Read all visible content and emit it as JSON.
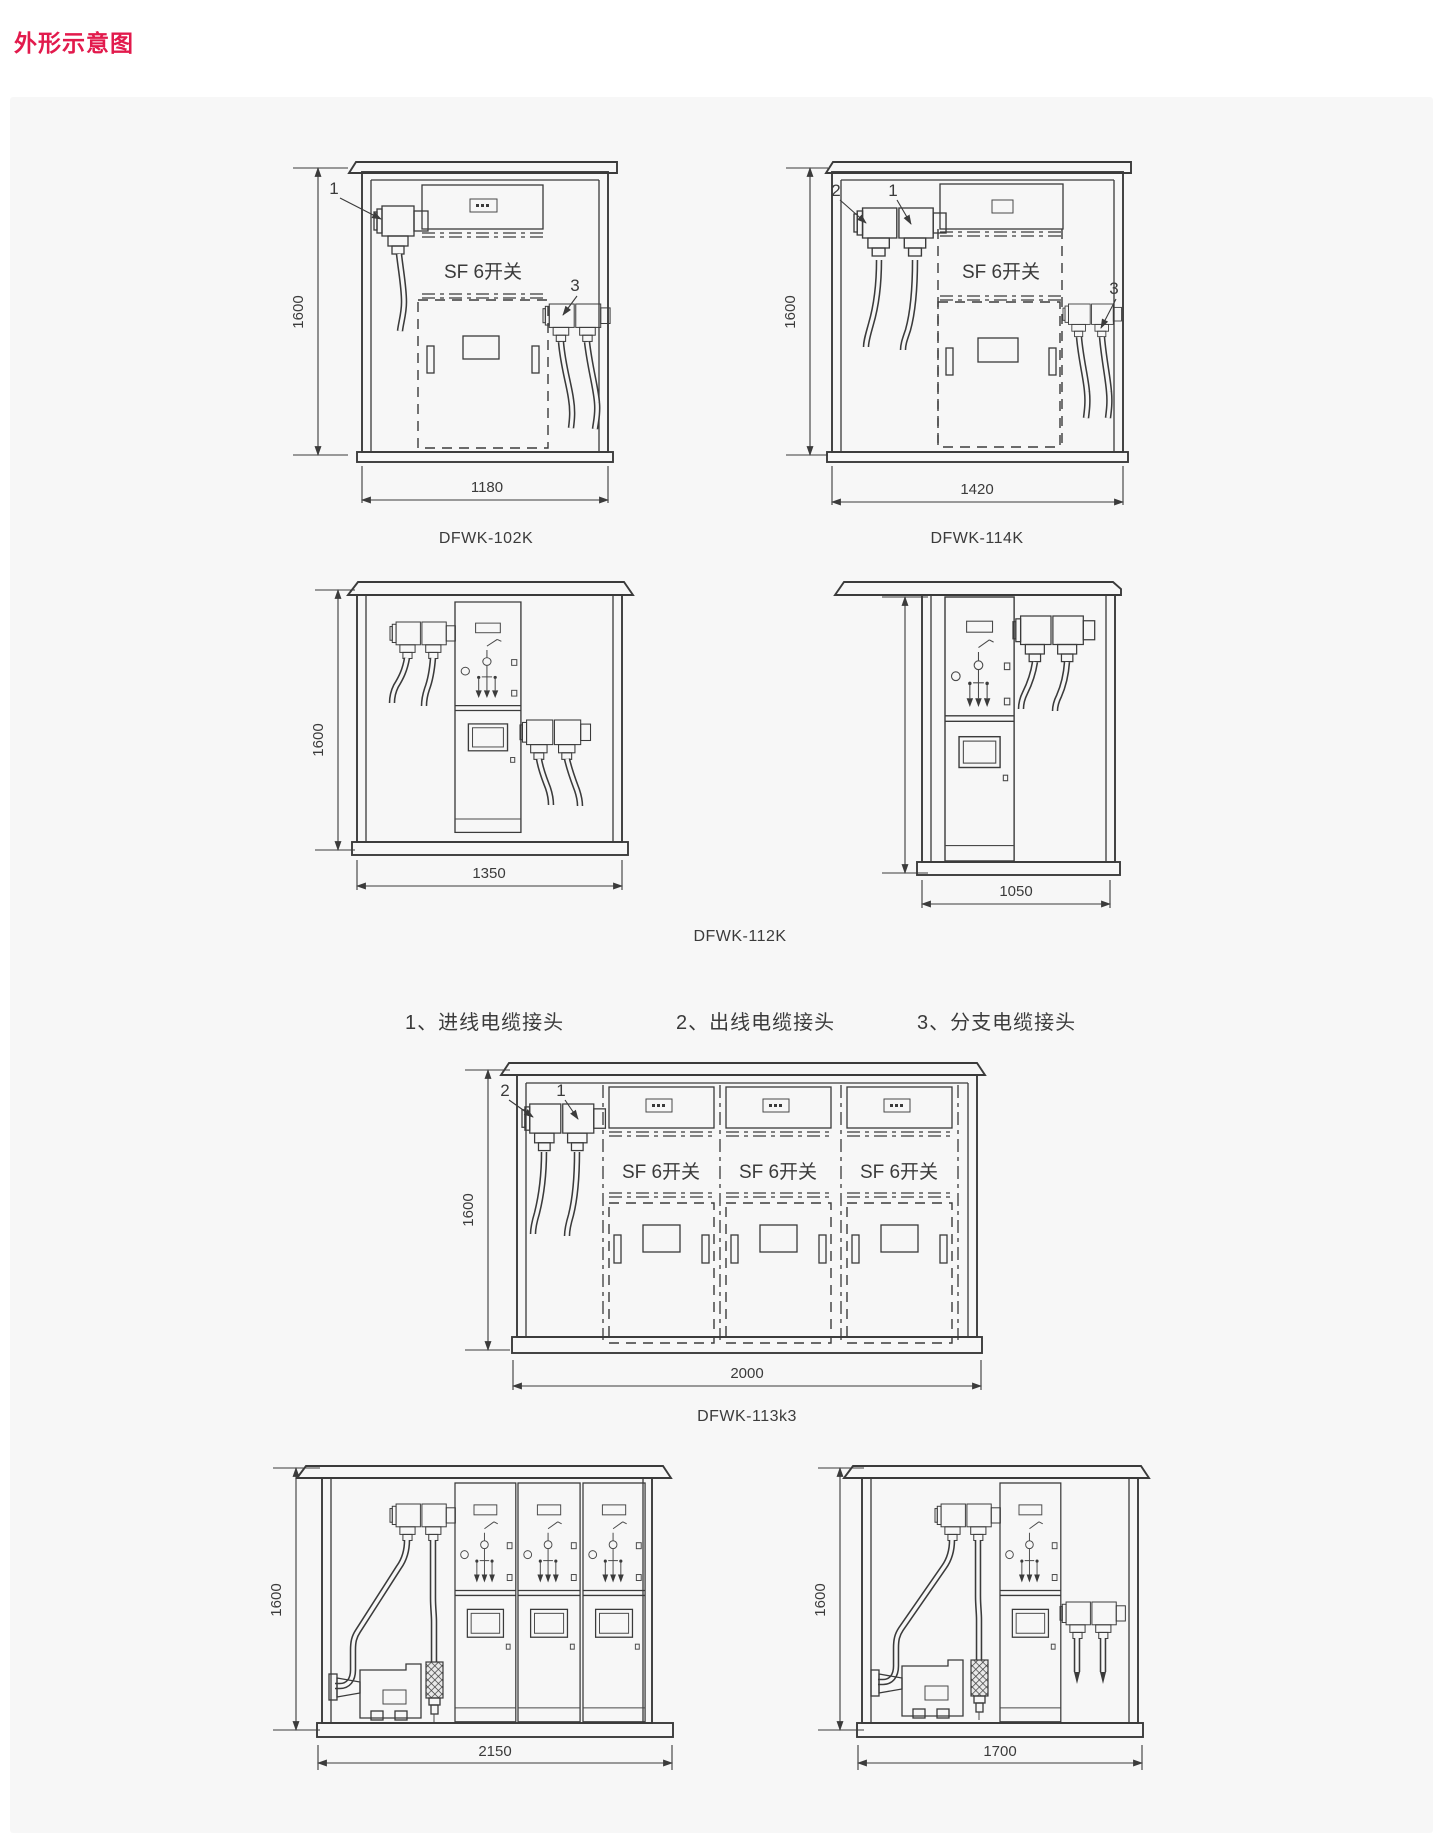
{
  "title": "外形示意图",
  "colors": {
    "accent_red": "#e21a4c",
    "panel_bg": "#f7f7f7",
    "ink": "#3b3b3b"
  },
  "labels": {
    "sf6_switch": "SF 6开关"
  },
  "callouts": {
    "inlet": "1",
    "outlet": "2",
    "branch": "3"
  },
  "legend": {
    "items": [
      {
        "text": "1、进线电缆接头"
      },
      {
        "text": "2、出线电缆接头"
      },
      {
        "text": "3、分支电缆接头"
      }
    ]
  },
  "diagrams": {
    "dfwk_102k": {
      "model": "DFWK-102K",
      "height_mm": "1600",
      "width_mm": "1180"
    },
    "dfwk_114k": {
      "model": "DFWK-114K",
      "height_mm": "1600",
      "width_mm": "1420"
    },
    "dfwk_112k": {
      "model": "DFWK-112K",
      "front": {
        "height_mm": "1600",
        "width_mm": "1350"
      },
      "side": {
        "width_mm": "1050"
      }
    },
    "dfwk_113k3": {
      "model": "DFWK-113k3",
      "height_mm": "1600",
      "width_mm": "2000"
    },
    "variant_2150": {
      "height_mm": "1600",
      "width_mm": "2150"
    },
    "variant_1700": {
      "height_mm": "1600",
      "width_mm": "1700"
    }
  }
}
